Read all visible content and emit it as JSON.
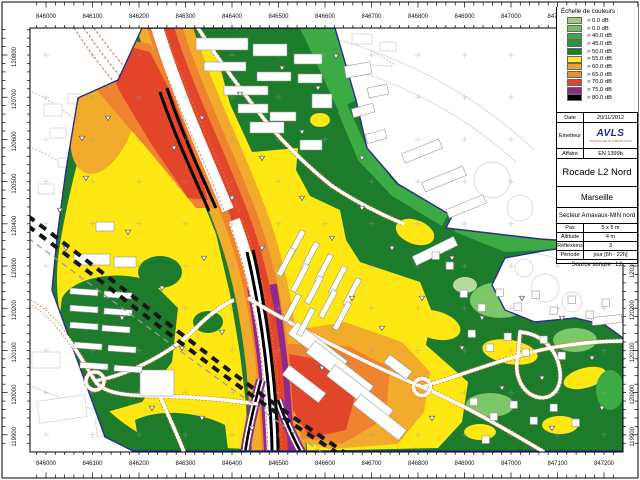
{
  "axes": {
    "x": [
      "846000",
      "846100",
      "846200",
      "846300",
      "846400",
      "846500",
      "846600",
      "846700",
      "846800",
      "846900",
      "847000",
      "847100",
      "847200"
    ],
    "y": [
      "120800",
      "120700",
      "120600",
      "120500",
      "120400",
      "120300",
      "120200",
      "120100",
      "120000",
      "119900"
    ]
  },
  "legend": {
    "title": "Échelle de couleurs :",
    "entries": [
      {
        "label": "> 0.0 dB",
        "color": "#9bcd7c"
      },
      {
        "label": "> 0.0 dB",
        "color": "#6fbf63"
      },
      {
        "label": "> 40.0 dB",
        "color": "#3cab43"
      },
      {
        "label": "> 45.0 dB",
        "color": "#2f9638"
      },
      {
        "label": "> 50.0 dB",
        "color": "#1d7c2c"
      },
      {
        "label": "> 55.0 dB",
        "color": "#ffe82e"
      },
      {
        "label": "> 60.0 dB",
        "color": "#eca32e"
      },
      {
        "label": "> 65.0 dB",
        "color": "#ee8a31"
      },
      {
        "label": "> 70.0 dB",
        "color": "#e2442c"
      },
      {
        "label": "> 75.0 dB",
        "color": "#8f2a8c"
      },
      {
        "label": "> 80.0 dB",
        "color": "#000000"
      }
    ]
  },
  "info_panel": {
    "date_label": "Date",
    "date_value": "20/11/2012",
    "emitter_label": "Emetteur",
    "logo": {
      "text": "AVLS",
      "caption": "ACOUSTIQUE VIBRATIONS"
    },
    "affaire_label": "Affaire",
    "affaire_value": "EN 1399b",
    "project_title": "Rocade L2 Nord",
    "city": "Marseille",
    "sector": "Secteur Arnavaux-MIN nord",
    "params": [
      {
        "label": "Pas",
        "value": "5 x 5 m"
      },
      {
        "label": "Altitude",
        "value": "4 m"
      },
      {
        "label": "Réflexions",
        "value": "3"
      },
      {
        "label": "Période",
        "value": "jour [6h - 22h]"
      }
    ],
    "source": "Source sonore : L2"
  },
  "map": {
    "colors": {
      "study_base_green": "#1d7c2c",
      "yellow_55db": "#ffe714",
      "amber_60db": "#f2ab2a",
      "orange_65db": "#ef8430",
      "red_70db": "#e2452a",
      "purple_75db": "#8f2a8c",
      "black_80db": "#000000",
      "boundary_line": "#2b2e8c",
      "road_edge": "#e07840"
    }
  }
}
